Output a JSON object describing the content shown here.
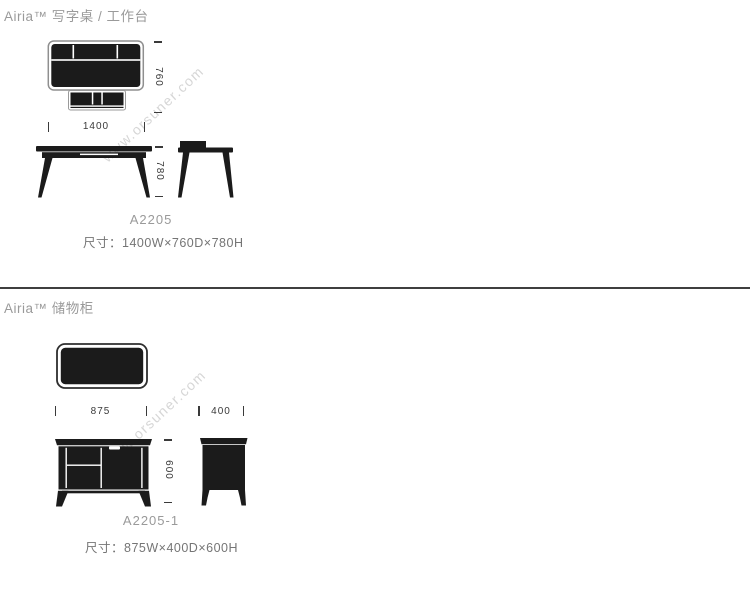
{
  "sections": [
    {
      "title": "Airia™ 写字桌 / 工作台",
      "model": "A2205",
      "size_label": "尺寸：1400W×760D×780H",
      "dims": {
        "width": "1400",
        "depth": "760",
        "height": "780"
      },
      "drawings": [
        "desk-top-view",
        "desk-front-view",
        "desk-side-view"
      ]
    },
    {
      "title": "Airia™  储物柜",
      "model": "A2205-1",
      "size_label": "尺寸：875W×400D×600H",
      "dims": {
        "width": "875",
        "depth": "400",
        "height": "600"
      },
      "drawings": [
        "cabinet-top-view",
        "cabinet-front-view",
        "cabinet-side-view"
      ]
    }
  ],
  "watermark": {
    "text": "www.orsuner.com"
  },
  "colors": {
    "title_gray": "#9a9a9a",
    "size_text_gray": "#757575",
    "dimension_text": "#3a3a3a",
    "drawing_fill": "#1b1b1b",
    "outline_gray": "#8f8f8f",
    "divider": "#3f3f3f",
    "watermark": "#d6d6d6",
    "background": "#ffffff"
  }
}
